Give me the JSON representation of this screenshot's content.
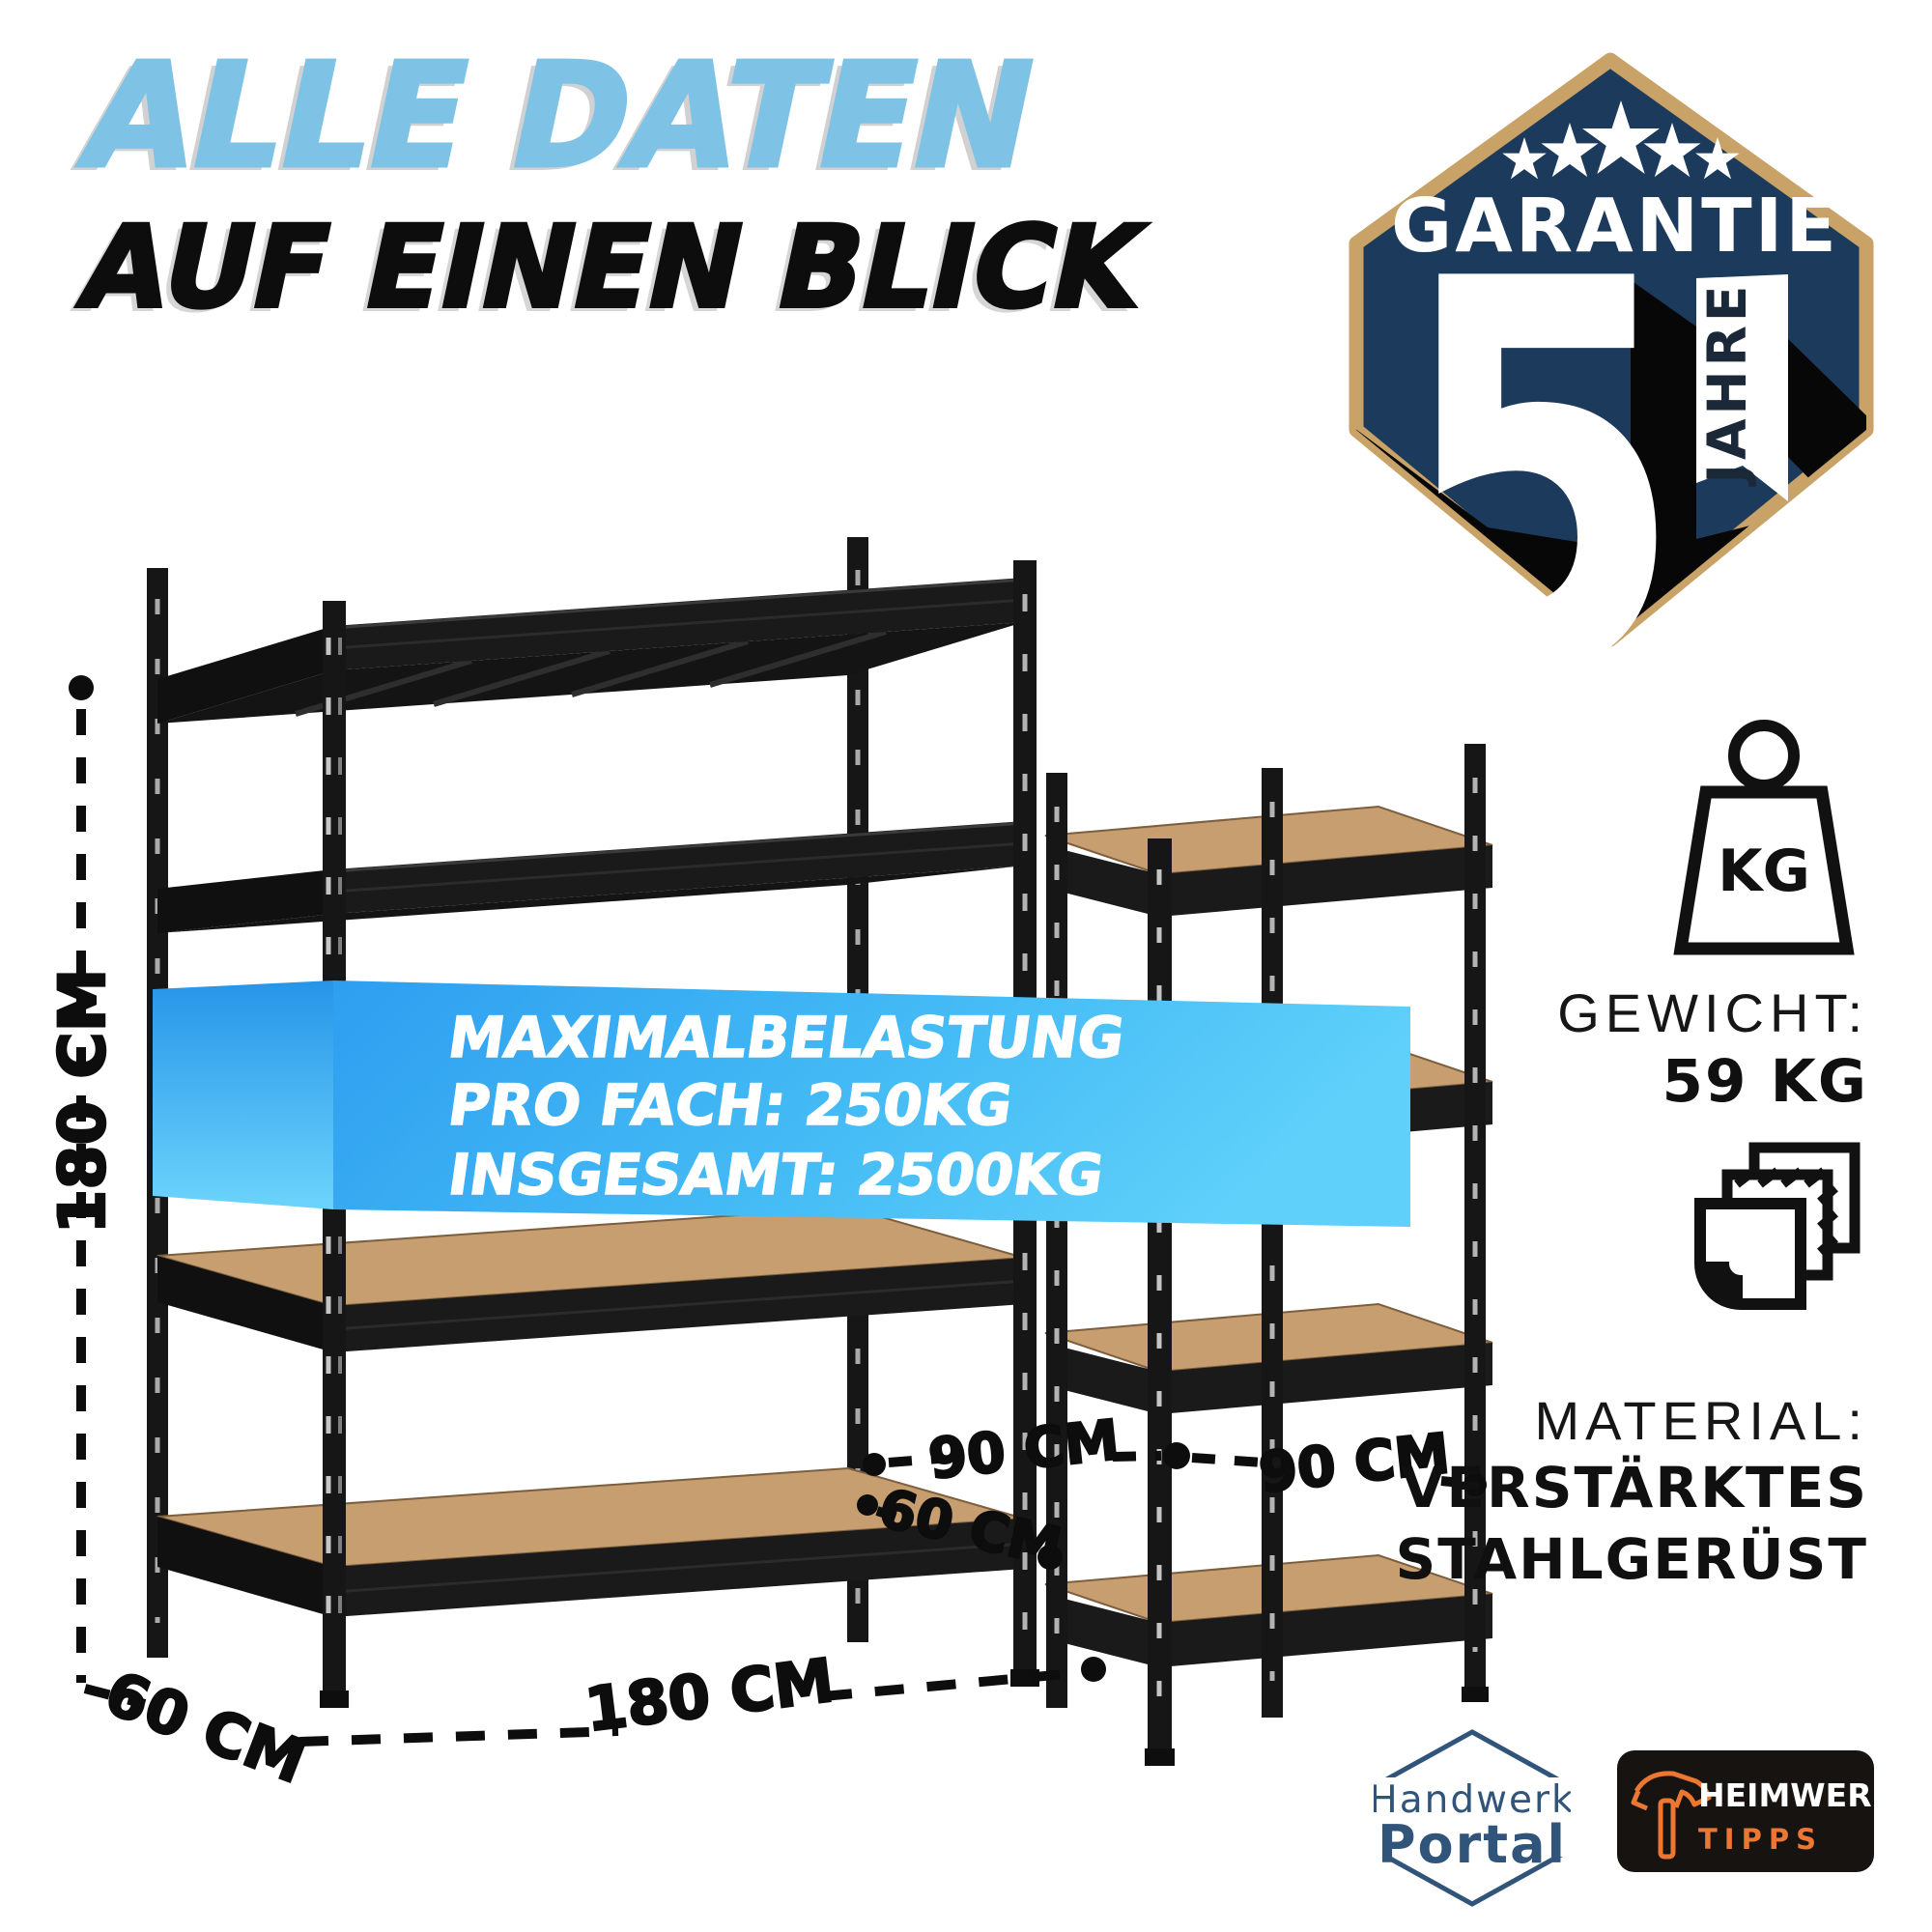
{
  "title": {
    "line1": "ALLE DATEN",
    "line2": "AUF EINEN BLICK"
  },
  "badge": {
    "word": "GARANTIE",
    "number": "5",
    "ribbon": "JAHRE",
    "stars": 5
  },
  "banner": {
    "line1": "MAXIMALBELASTUNG",
    "line2": "PRO FACH: 250KG",
    "line3": "INSGESAMT: 2500KG"
  },
  "dimensions": {
    "height": "180 CM",
    "depth_front": "60 CM",
    "width": "180 CM",
    "bay_left": "90 CM",
    "bay_right": "90 CM",
    "corner_depth": "60 CM"
  },
  "specs": {
    "weight_icon_text": "KG",
    "weight_label": "GEWICHT:",
    "weight_value": "59 KG",
    "material_label": "MATERIAL:",
    "material_value_line1": "VERSTÄRKTES",
    "material_value_line2": "STAHLGERÜST"
  },
  "logos": {
    "handwerk": {
      "line1": "Handwerk",
      "line2": "Portal"
    },
    "heimwerker": {
      "line1": "HEIMWERKER",
      "line2": "TIPPS"
    }
  },
  "colors": {
    "accent_light_blue": "#7EC3E6",
    "banner_blue_dark": "#2E9EF0",
    "banner_blue_light": "#5FD0FA",
    "badge_navy": "#1C3A5C",
    "badge_gold": "#C8A266",
    "logo_navy": "#31547A",
    "logo_orange": "#EC7733",
    "wood": "#C69E70",
    "ink": "#0D0D0D"
  }
}
